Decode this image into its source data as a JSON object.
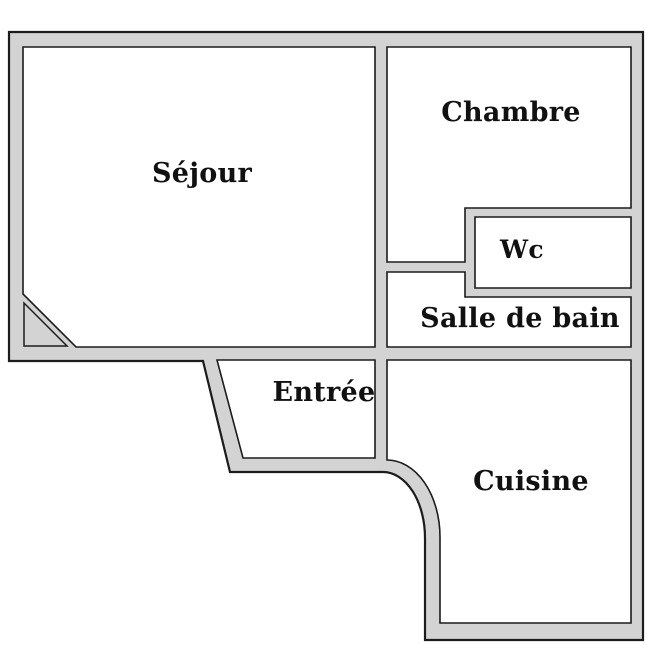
{
  "plan": {
    "type": "apartment-floor-plan",
    "rooms": [
      {
        "id": "sejour",
        "label": "Séjour"
      },
      {
        "id": "chambre",
        "label": "Chambre"
      },
      {
        "id": "wc",
        "label": "Wc"
      },
      {
        "id": "salle-de-bain",
        "label": "Salle de bain"
      },
      {
        "id": "entree",
        "label": "Entrée"
      },
      {
        "id": "cuisine",
        "label": "Cuisine"
      }
    ],
    "colors": {
      "wall_fill": "#d3d3d3",
      "wall_stroke": "#1c1c1c",
      "room_fill": "#ffffff",
      "text": "#111111",
      "background": "#ffffff"
    }
  }
}
